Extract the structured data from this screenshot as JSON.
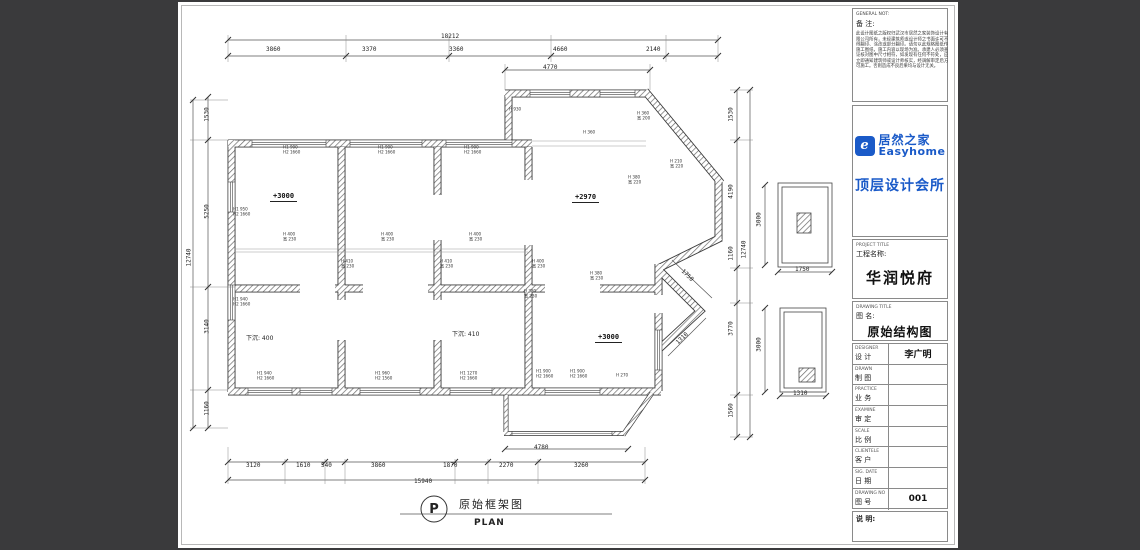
{
  "colors": {
    "canvas_bg": "#3a3a3c",
    "sheet_bg": "#ffffff",
    "brand_blue": "#1a5ac8",
    "line": "#444444"
  },
  "titleblock": {
    "general_en": "GENERAL NOT:",
    "note_label": "备 注:",
    "note_text": "此设计图纸之版权归武汉市居然之家装饰设计有限公司所有，未经建筑师或设计师之书面许可不得翻印、涂改或部分翻印。请勿以此规格图纸作施工图纸，施工内容以现场为准。承建人必须查证核对图中尺寸相符，如发现有任何不符处，应立即通知建筑师或设计师核实，经调解审定后方可施工。否则造成不良后果均与设计无关。",
    "logo": {
      "brand_cn": "居然之家",
      "brand_en": "Easyhome",
      "icon_glyph": "e",
      "studio": "顶层设计会所"
    },
    "project": {
      "label_en": "PROJECT TITLE",
      "label_cn": "工程名称:",
      "value": "华润悦府"
    },
    "drawing": {
      "label_en": "DRAWING TITLE",
      "label_cn": "图  名:",
      "value": "原始结构图"
    },
    "rows": [
      {
        "en": "DESIGNER",
        "cn": "设 计",
        "value": "李广明"
      },
      {
        "en": "DRAWN",
        "cn": "制 图",
        "value": ""
      },
      {
        "en": "PRACTICE",
        "cn": "业 务",
        "value": ""
      },
      {
        "en": "EXAMINE",
        "cn": "审 定",
        "value": ""
      },
      {
        "en": "SCALE",
        "cn": "比 例",
        "value": ""
      },
      {
        "en": "CLIENTELE",
        "cn": "客 户",
        "value": ""
      },
      {
        "en": "SIG. DATE",
        "cn": "日 期",
        "value": ""
      },
      {
        "en": "DRAWING NO",
        "cn": "图 号",
        "value": "001"
      }
    ],
    "remark_label": "说  明:"
  },
  "plan": {
    "caption": {
      "letter": "P",
      "title_cn": "原始框架图",
      "title_en": "PLAN"
    },
    "levels": [
      {
        "x": 92,
        "y": 190,
        "t": "+3000"
      },
      {
        "x": 394,
        "y": 191,
        "t": "+2970"
      },
      {
        "x": 417,
        "y": 331,
        "t": "+3000"
      }
    ],
    "sunken": [
      {
        "x": 68,
        "y": 331,
        "t": "下沉: 400"
      },
      {
        "x": 274,
        "y": 327,
        "t": "下沉: 410"
      }
    ],
    "dims": [
      {
        "x": 263,
        "y": 31,
        "t": "18212"
      },
      {
        "x": 88,
        "y": 44,
        "t": "3860"
      },
      {
        "x": 184,
        "y": 44,
        "t": "3370"
      },
      {
        "x": 271,
        "y": 44,
        "t": "3360"
      },
      {
        "x": 375,
        "y": 44,
        "t": "4660"
      },
      {
        "x": 468,
        "y": 44,
        "t": "2140"
      },
      {
        "x": 365,
        "y": 62,
        "t": "4770"
      },
      {
        "x": 68,
        "y": 460,
        "t": "3120"
      },
      {
        "x": 118,
        "y": 460,
        "t": "1610"
      },
      {
        "x": 143,
        "y": 460,
        "t": "540"
      },
      {
        "x": 193,
        "y": 460,
        "t": "3860"
      },
      {
        "x": 265,
        "y": 460,
        "t": "1870"
      },
      {
        "x": 321,
        "y": 460,
        "t": "2270"
      },
      {
        "x": 396,
        "y": 460,
        "t": "3260"
      },
      {
        "x": 236,
        "y": 476,
        "t": "15940"
      },
      {
        "x": 356,
        "y": 442,
        "t": "4780"
      },
      {
        "x": 2,
        "y": 252,
        "t": "12740",
        "r": -90
      },
      {
        "x": 22,
        "y": 109,
        "t": "1530",
        "r": -90
      },
      {
        "x": 22,
        "y": 206,
        "t": "5250",
        "r": -90
      },
      {
        "x": 22,
        "y": 321,
        "t": "3140",
        "r": -90
      },
      {
        "x": 22,
        "y": 403,
        "t": "1160",
        "r": -90
      },
      {
        "x": 557,
        "y": 244,
        "t": "12740",
        "r": -90
      },
      {
        "x": 546,
        "y": 109,
        "t": "1530",
        "r": -90
      },
      {
        "x": 546,
        "y": 186,
        "t": "4190",
        "r": -90
      },
      {
        "x": 546,
        "y": 248,
        "t": "1160",
        "r": -90
      },
      {
        "x": 546,
        "y": 323,
        "t": "3770",
        "r": -90
      },
      {
        "x": 546,
        "y": 405,
        "t": "1560",
        "r": -90
      },
      {
        "x": 574,
        "y": 214,
        "t": "3000",
        "r": -90
      },
      {
        "x": 574,
        "y": 339,
        "t": "3000",
        "r": -90
      },
      {
        "x": 617,
        "y": 264,
        "t": "1750"
      },
      {
        "x": 615,
        "y": 388,
        "t": "1310"
      },
      {
        "x": 502,
        "y": 270,
        "t": "1750",
        "r": 44
      },
      {
        "x": 497,
        "y": 333,
        "t": "1310",
        "r": -44
      }
    ],
    "notes": [
      {
        "x": 105,
        "y": 144,
        "a": "H1 900",
        "b": "H2 1660"
      },
      {
        "x": 200,
        "y": 144,
        "a": "H1 900",
        "b": "H2 1660"
      },
      {
        "x": 286,
        "y": 144,
        "a": "H1 900",
        "b": "H2 1660"
      },
      {
        "x": 55,
        "y": 206,
        "a": "H1 950",
        "b": "H2 1660"
      },
      {
        "x": 105,
        "y": 231,
        "a": "H 400",
        "b": "宽 230"
      },
      {
        "x": 203,
        "y": 231,
        "a": "H 400",
        "b": "宽 230"
      },
      {
        "x": 291,
        "y": 231,
        "a": "H 400",
        "b": "宽 230"
      },
      {
        "x": 163,
        "y": 258,
        "a": "H 410",
        "b": "宽 230"
      },
      {
        "x": 262,
        "y": 258,
        "a": "H 410",
        "b": "宽 230"
      },
      {
        "x": 354,
        "y": 258,
        "a": "H 400",
        "b": "宽 230"
      },
      {
        "x": 412,
        "y": 270,
        "a": "H 380",
        "b": "宽 230"
      },
      {
        "x": 331,
        "y": 106,
        "a": "H 930",
        "b": ""
      },
      {
        "x": 459,
        "y": 110,
        "a": "H 360",
        "b": "宽 200"
      },
      {
        "x": 405,
        "y": 129,
        "a": "H 360",
        "b": ""
      },
      {
        "x": 492,
        "y": 158,
        "a": "H 210",
        "b": "宽 220"
      },
      {
        "x": 450,
        "y": 174,
        "a": "H 380",
        "b": "宽 220"
      },
      {
        "x": 55,
        "y": 296,
        "a": "H1 940",
        "b": "H2 1660"
      },
      {
        "x": 79,
        "y": 370,
        "a": "H1 940",
        "b": "H2 1660"
      },
      {
        "x": 197,
        "y": 370,
        "a": "H1 960",
        "b": "H2 1560"
      },
      {
        "x": 282,
        "y": 370,
        "a": "H1 1270",
        "b": "H2 1660"
      },
      {
        "x": 358,
        "y": 368,
        "a": "H1 900",
        "b": "H2 1660"
      },
      {
        "x": 392,
        "y": 368,
        "a": "H1 900",
        "b": "H2 1660"
      },
      {
        "x": 438,
        "y": 372,
        "a": "H 270",
        "b": ""
      },
      {
        "x": 346,
        "y": 288,
        "a": "H 380",
        "b": "宽 230"
      }
    ]
  }
}
